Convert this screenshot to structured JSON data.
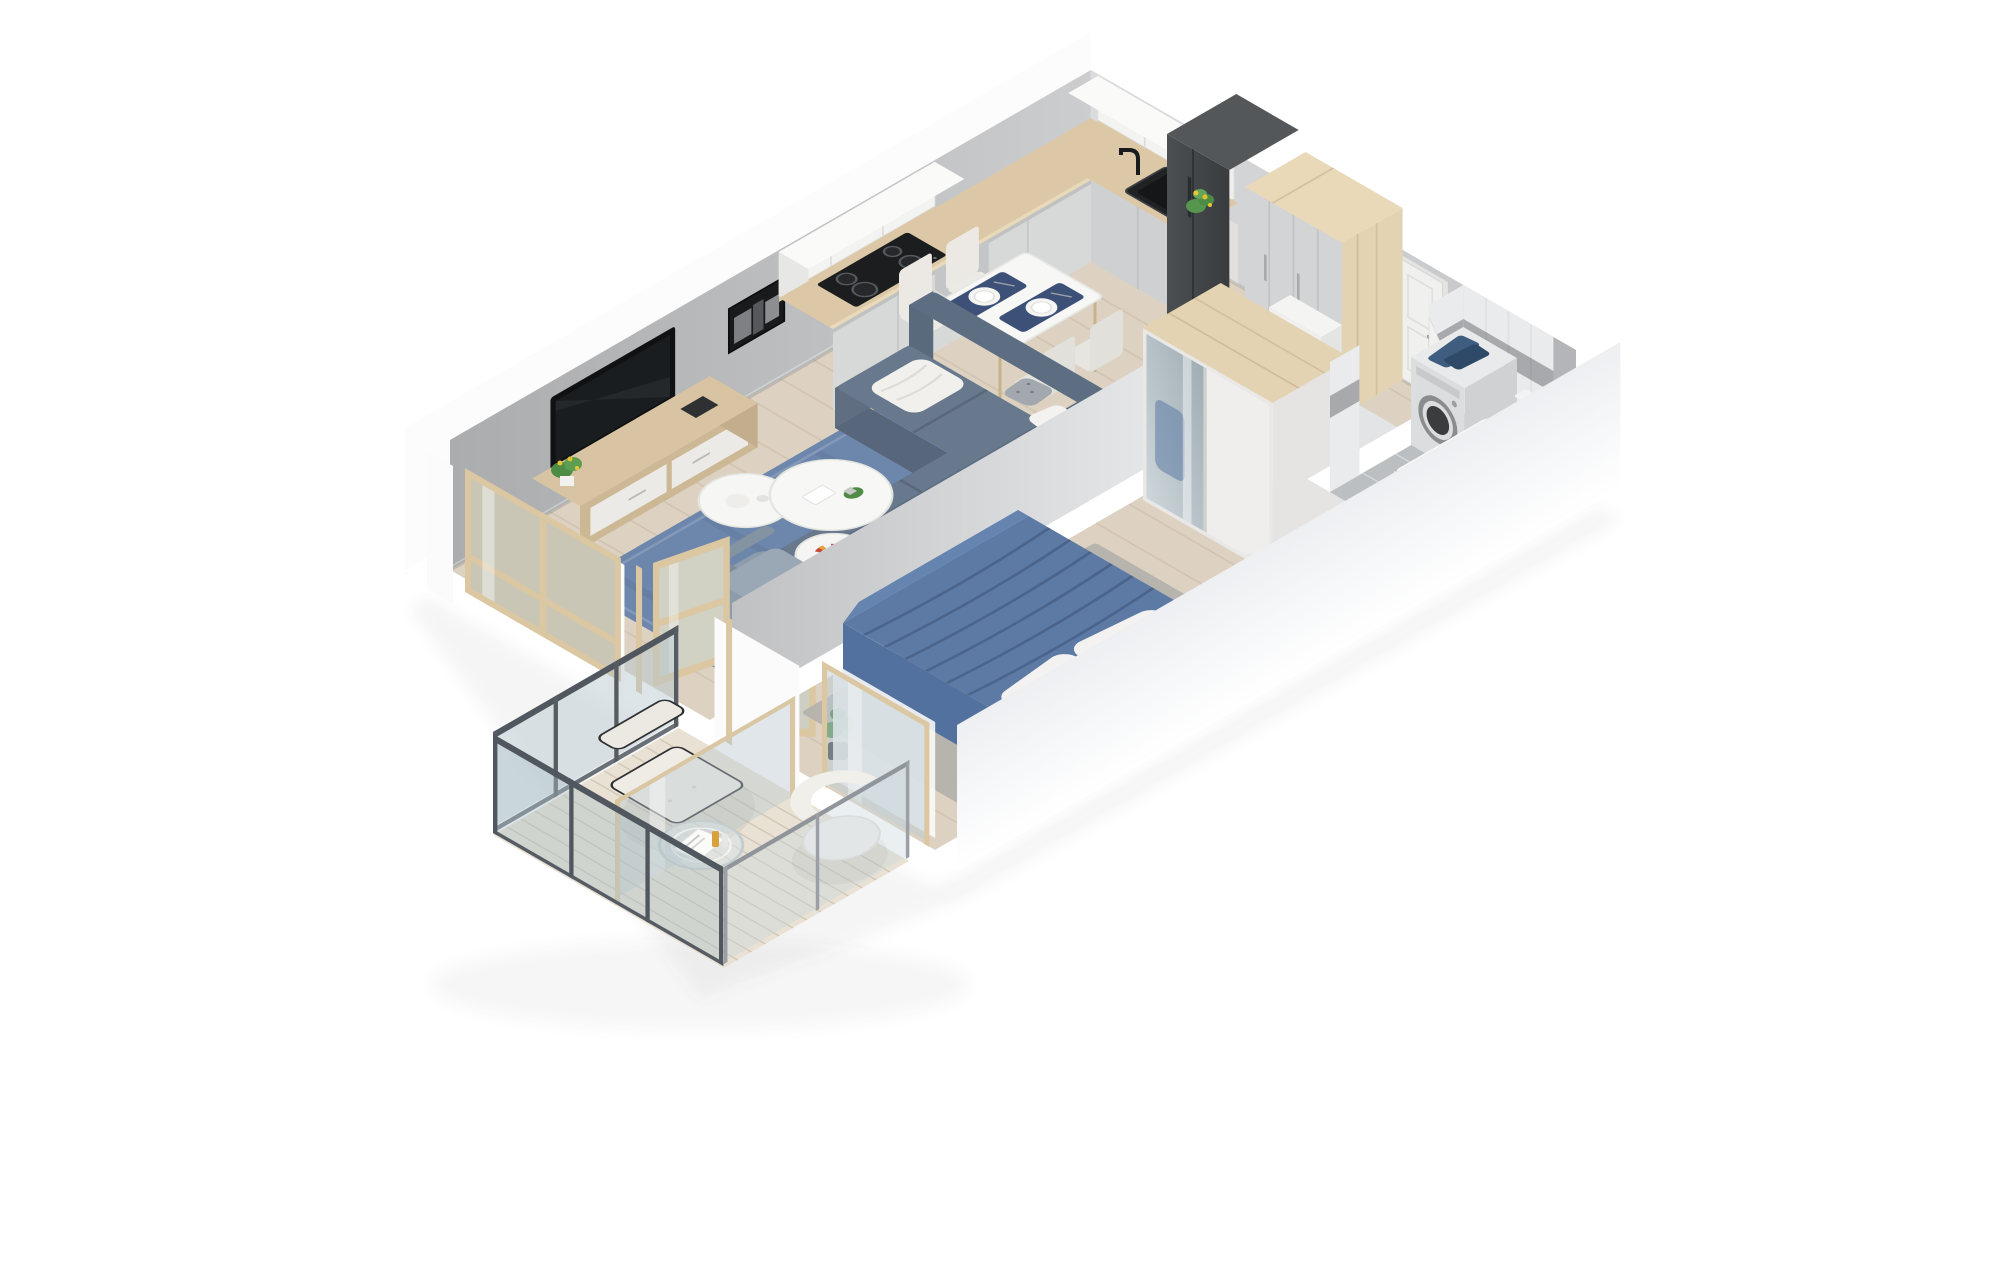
{
  "scene": {
    "kind": "isometric-3d-floor-plan-render",
    "description": "Top-down isometric 3D render of a one-bedroom apartment with open living room and kitchen, hallway, bathroom, bedroom and balcony. Cut white walls, light wood floors, blue textile accents. No text labels in image.",
    "background": "#ffffff"
  },
  "colors": {
    "floor_wood": "#ddd2c1",
    "wall_outer": "#fbfbfc",
    "wall_top": "#ffffff",
    "rug_blue": "#6d86ac",
    "sofa": "#68798d",
    "armchair": "#8c9caa",
    "table_white": "#f7f7f5",
    "chair_cream": "#ebeae5",
    "placemat_navy": "#3c5078",
    "counter_wood": "#dcc8a6",
    "cabinet_front": "#d7d8d8",
    "upper_cabinet": "#f3f3f2",
    "cooktop": "#1b1d1f",
    "sink": "#202224",
    "appliance_dark": "#45484b",
    "wardrobe_wood": "#e4d3b3",
    "wardrobe_front": "#d3d4d5",
    "door_white": "#f0f0ef",
    "tile_floor": "#bcbfc2",
    "tile_band": "#a7a9ac",
    "washer": "#dcddde",
    "towel_navy": "#3f5d7e",
    "bed_blue": "#5d7aa5",
    "pillow_white": "#f3f2f0",
    "bedroom_rug": "#b7b4ae",
    "mirror": "#b8c3c8",
    "glass": "rgba(180,198,207,0.45)",
    "frame_wood": "#dbc7a2",
    "railing_dark": "#51575e",
    "deck": "#e9e2d4",
    "plant_green": "#4e8c46",
    "flower_yellow": "#e8c832"
  },
  "rooms": {
    "living_room": {
      "label": "living room",
      "items": [
        "wall TV",
        "wood TV stand",
        "blue rug",
        "corner sofa",
        "armchair",
        "nesting coffee tables",
        "black and white wall art",
        "window"
      ]
    },
    "dining": {
      "label": "dining area",
      "items": [
        "white table",
        "four cream chairs",
        "two navy placemats with plates"
      ]
    },
    "kitchen": {
      "label": "kitchen",
      "items": [
        "L-shaped counter",
        "cooktop",
        "black sink",
        "upper cabinets",
        "fridge",
        "tall cabinet",
        "plant"
      ]
    },
    "hallway": {
      "label": "hallway",
      "items": [
        "entrance door",
        "wardrobe",
        "low cabinet"
      ]
    },
    "bathroom": {
      "label": "bathroom",
      "items": [
        "washing machine",
        "navy towels",
        "bathtub",
        "toilet",
        "tiled walls",
        "door"
      ]
    },
    "bedroom": {
      "label": "bedroom",
      "items": [
        "double bed",
        "blue bedding",
        "mirror wardrobe",
        "gray rug",
        "candles",
        "plant",
        "door"
      ]
    },
    "balcony": {
      "label": "balcony",
      "items": [
        "glass railing",
        "lounge chair",
        "glass side table",
        "white armchair",
        "glass divider",
        "wood decking"
      ]
    }
  }
}
